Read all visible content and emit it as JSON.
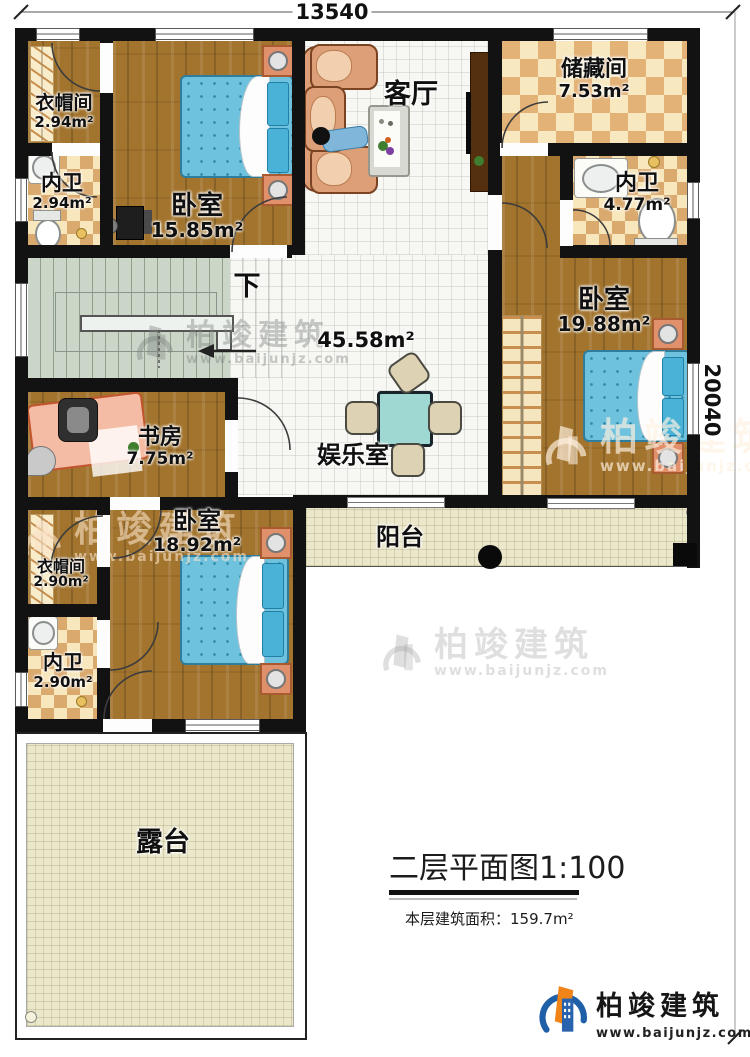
{
  "dimensions": {
    "width_label": "13540",
    "height_label": "20040"
  },
  "rooms": {
    "cloak_tl": {
      "label": "衣帽间",
      "area": "2.94m²"
    },
    "bath_tl": {
      "label": "内卫",
      "area": "2.94m²"
    },
    "bed_tl": {
      "label": "卧室",
      "area": "15.85m²"
    },
    "living": {
      "label": "客厅"
    },
    "storage": {
      "label": "储藏间",
      "area": "7.53m²"
    },
    "bath_r": {
      "label": "内卫",
      "area": "4.77m²"
    },
    "bed_r": {
      "label": "卧室",
      "area": "19.88m²"
    },
    "hall": {
      "area": "45.58m²"
    },
    "stairs": {
      "label": "下"
    },
    "study": {
      "label": "书房",
      "area": "7.75m²"
    },
    "entertainment": {
      "label": "娱乐室"
    },
    "bed_bl": {
      "label": "卧室",
      "area": "18.92m²"
    },
    "cloak_bl": {
      "label": "衣帽间",
      "area": "2.90m²"
    },
    "bath_bl": {
      "label": "内卫",
      "area": "2.90m²"
    },
    "balcony": {
      "label": "阳台"
    },
    "terrace": {
      "label": "露台"
    }
  },
  "title_block": {
    "title": "二层平面图1:100",
    "area_label": "本层建筑面积：",
    "area_value": "159.7m²"
  },
  "brand": {
    "name": "柏竣建筑",
    "url": "www.baijunjz.com"
  },
  "watermark": {
    "name": "柏竣建筑",
    "url": "www.baijunjz.com"
  },
  "colors": {
    "wall": "#121212",
    "wood": "#a2742e",
    "checker_light": "#f8e7bd",
    "checker_dark": "#d9a96e",
    "bed_blue": "#6fc2de",
    "accent_orange": "#f08418",
    "brand_blue": "#1f5fa8"
  }
}
